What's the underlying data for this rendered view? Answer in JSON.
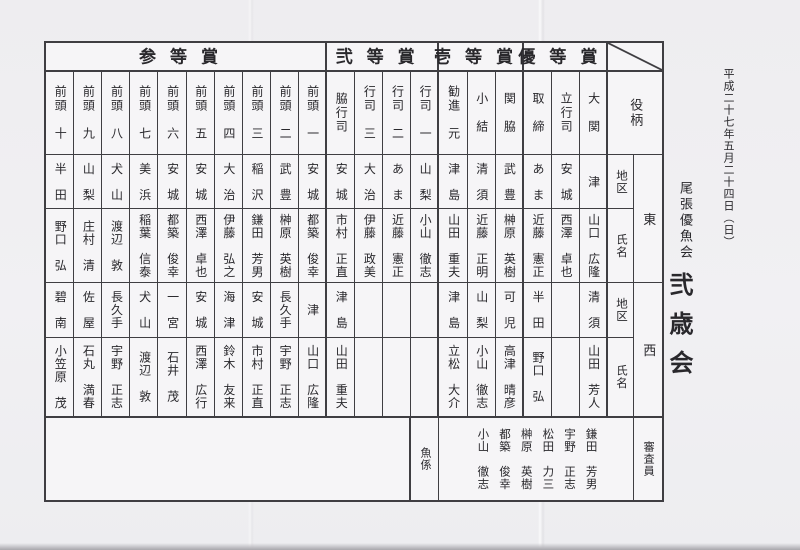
{
  "annotations": {
    "date": "平成二十七年五月二十四日（日）",
    "club": "尾張優魚会",
    "event": "弐歳会"
  },
  "colors": {
    "paper": "#efeef1",
    "table_background": "#f6f5f7",
    "line": "#3f3e42",
    "text": "#29282c",
    "scan_edge": "#b3b2b7"
  },
  "table": {
    "labels": {
      "role": "役柄",
      "district": "地区",
      "name": "氏名",
      "east": "東",
      "west": "西",
      "fish_staff": "魚係",
      "judges": "審査員"
    },
    "sections": [
      {
        "title": "参等賞",
        "columns": [
          {
            "rank": "前頭　十",
            "east_district": "半　田",
            "east_name": "野口　弘",
            "west_district": "碧　南",
            "west_name": "小笠原　茂"
          },
          {
            "rank": "前頭　九",
            "east_district": "山　梨",
            "east_name": "庄村　清",
            "west_district": "佐　屋",
            "west_name": "石丸　満春"
          },
          {
            "rank": "前頭　八",
            "east_district": "犬　山",
            "east_name": "渡辺　敦",
            "west_district": "長久手",
            "west_name": "宇野　正志"
          },
          {
            "rank": "前頭　七",
            "east_district": "美　浜",
            "east_name": "稲葉　信泰",
            "west_district": "犬　山",
            "west_name": "渡辺　敦"
          },
          {
            "rank": "前頭　六",
            "east_district": "安　城",
            "east_name": "都築　俊幸",
            "west_district": "一　宮",
            "west_name": "石井　茂"
          },
          {
            "rank": "前頭　五",
            "east_district": "安　城",
            "east_name": "西澤　卓也",
            "west_district": "安　城",
            "west_name": "西澤　広行"
          },
          {
            "rank": "前頭　四",
            "east_district": "大　治",
            "east_name": "伊藤　弘之",
            "west_district": "海　津",
            "west_name": "鈴木　友来"
          },
          {
            "rank": "前頭　三",
            "east_district": "稲　沢",
            "east_name": "鎌田　芳男",
            "west_district": "安　城",
            "west_name": "市村　正直"
          },
          {
            "rank": "前頭　二",
            "east_district": "武　豊",
            "east_name": "榊原　英樹",
            "west_district": "長久手",
            "west_name": "宇野　正志"
          },
          {
            "rank": "前頭　一",
            "east_district": "安　城",
            "east_name": "都築　俊幸",
            "west_district": "津",
            "west_name": "山口　広隆"
          }
        ]
      },
      {
        "title": "弐等賞",
        "columns": [
          {
            "rank": "脇行司",
            "east_district": "安　城",
            "east_name": "市村　正直",
            "west_district": "津　島",
            "west_name": "山田　重夫"
          },
          {
            "rank": "行司　三",
            "east_district": "大　治",
            "east_name": "伊藤　政美",
            "west_district": "",
            "west_name": ""
          },
          {
            "rank": "行司　二",
            "east_district": "あ　ま",
            "east_name": "近藤　憲正",
            "west_district": "",
            "west_name": ""
          },
          {
            "rank": "行司　一",
            "east_district": "山　梨",
            "east_name": "小山　徹志",
            "west_district": "",
            "west_name": ""
          }
        ]
      },
      {
        "title": "壱等賞",
        "columns": [
          {
            "rank": "勧進　元",
            "east_district": "津　島",
            "east_name": "山田　重夫",
            "west_district": "津　島",
            "west_name": "立松　大介"
          },
          {
            "rank": "小　結",
            "east_district": "清　須",
            "east_name": "近藤　正明",
            "west_district": "山　梨",
            "west_name": "小山　徹志"
          },
          {
            "rank": "関　脇",
            "east_district": "武　豊",
            "east_name": "榊原　英樹",
            "west_district": "可　児",
            "west_name": "高津　晴彦"
          }
        ]
      },
      {
        "title": "優等賞",
        "columns": [
          {
            "rank": "取　締",
            "east_district": "あ　ま",
            "east_name": "近藤　憲正",
            "west_district": "半　田",
            "west_name": "野口　弘"
          },
          {
            "rank": "立行司",
            "east_district": "安　城",
            "east_name": "西澤　卓也",
            "west_district": "",
            "west_name": ""
          },
          {
            "rank": "大　関",
            "east_district": "津",
            "east_name": "山口　広隆",
            "west_district": "清　須",
            "west_name": "山田　芳人"
          }
        ]
      }
    ],
    "judges": [
      "小山　徹志",
      "都築　俊幸",
      "榊原　英樹",
      "松田　力三",
      "宇野　正志",
      "鎌田　芳男"
    ]
  }
}
